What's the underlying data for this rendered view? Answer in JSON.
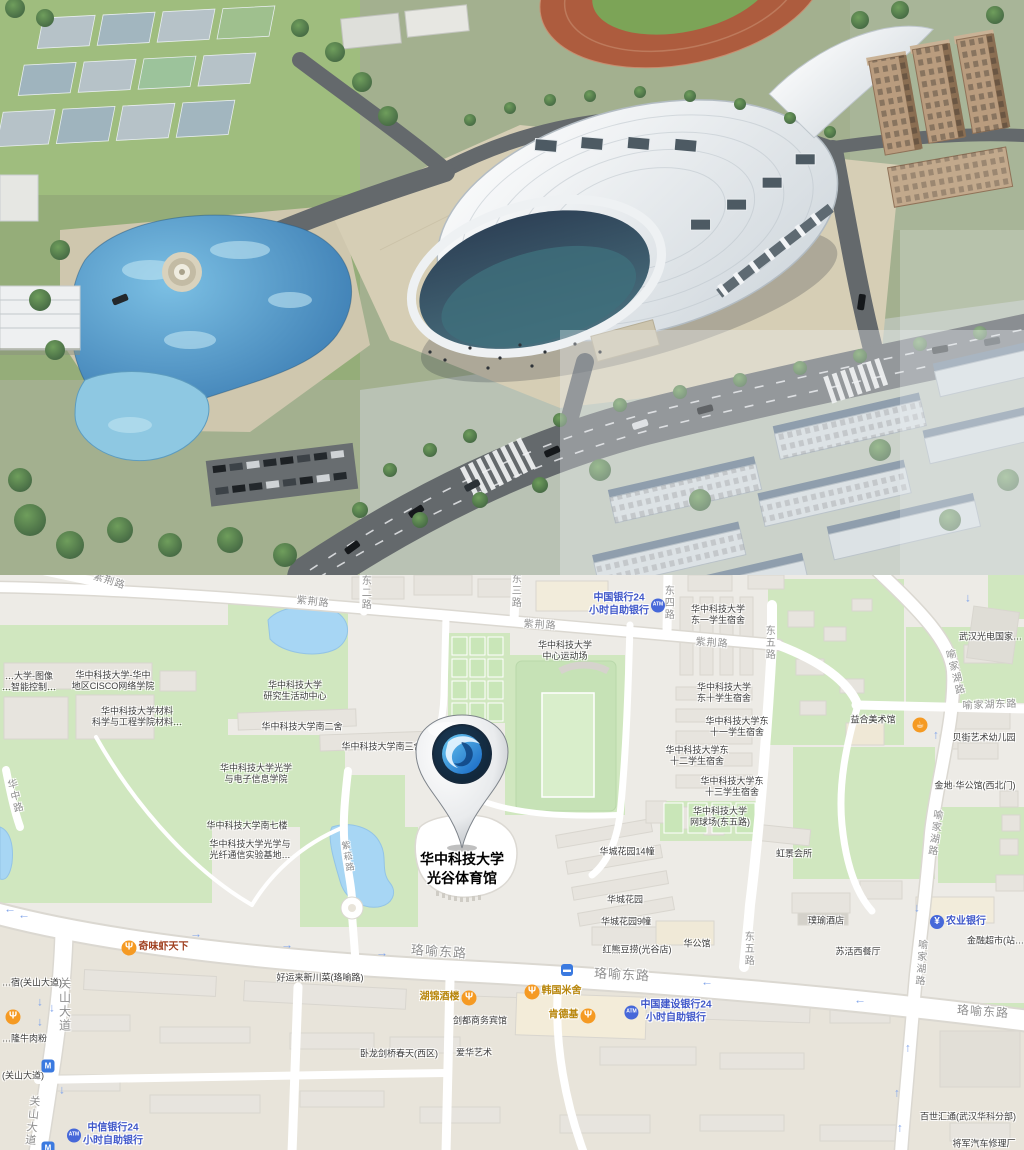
{
  "rendering": {
    "description": "Aerial architectural rendering of a large white oval-roofed gymnasium with glass facade, surrounded by a tan plaza, a blue landscaped swimming lagoon with circular fountain plaza, tennis courts and a running track to the north, perimeter roads with cars, zebra crossings, a parking lot, and rows of apartment buildings to the south-east"
  },
  "map": {
    "pin": {
      "label_line1": "华中科技大学",
      "label_line2": "光谷体育馆"
    },
    "colors": {
      "bank_blue": "#3f57c9",
      "food_gold": "#b8860b",
      "food_red": "#a04020",
      "poi_icon_orange": "#f59a23",
      "road_label_gray": "#8f8f8f",
      "poi_text": "#3c3c3c",
      "park_green": "#d0e7bf",
      "water_blue": "#a7d6f4",
      "map_bg": "#edebe6",
      "pin_logo_blue": "#2b7fd4"
    },
    "icons_legend": {
      "atm": "ATM",
      "yuan": "¥",
      "fork": "Ψ",
      "cup": "☕",
      "bus": "▬",
      "metro": "M"
    },
    "labels": [
      {
        "id": "zijing-1",
        "type": "road",
        "text": "紫荆路",
        "x": 109,
        "y": 7,
        "rot": 18
      },
      {
        "id": "zijing-2",
        "type": "road",
        "text": "紫荆路",
        "x": 313,
        "y": 28,
        "rot": 6
      },
      {
        "id": "zijing-3",
        "type": "road",
        "text": "紫荆路",
        "x": 540,
        "y": 51,
        "rot": 4
      },
      {
        "id": "zijing-4",
        "type": "road",
        "text": "紫荆路",
        "x": 712,
        "y": 69,
        "rot": 4
      },
      {
        "id": "dong2",
        "type": "road",
        "v": 1,
        "text": "东二路",
        "x": 364,
        "y": 18
      },
      {
        "id": "dong3",
        "type": "road",
        "v": 1,
        "text": "东三路",
        "x": 514,
        "y": 16
      },
      {
        "id": "dong4",
        "type": "road",
        "v": 1,
        "text": "东四路",
        "x": 667,
        "y": 28
      },
      {
        "id": "dong5-n",
        "type": "road",
        "v": 1,
        "text": "东五路",
        "x": 768,
        "y": 68
      },
      {
        "id": "dong5-s",
        "type": "road",
        "v": 1,
        "text": "东五路",
        "x": 747,
        "y": 374
      },
      {
        "id": "yujiahu-1",
        "type": "road",
        "v": 1,
        "text": "喻家湖路",
        "x": 953,
        "y": 98,
        "rot": -14
      },
      {
        "id": "yujiahu-2",
        "type": "road",
        "v": 1,
        "text": "喻家湖路",
        "x": 933,
        "y": 258,
        "rot": 8
      },
      {
        "id": "yujiahu-3",
        "type": "road",
        "v": 1,
        "text": "喻家湖路",
        "x": 919,
        "y": 388,
        "rot": 4
      },
      {
        "id": "yujiahu-dong",
        "type": "road",
        "text": "喻家湖东路",
        "x": 990,
        "y": 131,
        "rot": -2
      },
      {
        "id": "luoyu-1",
        "type": "road",
        "size": 13,
        "text": "珞喻东路",
        "x": 439,
        "y": 377,
        "rot": 4
      },
      {
        "id": "luoyu-2",
        "type": "road",
        "size": 13,
        "text": "珞喻东路",
        "x": 622,
        "y": 400,
        "rot": 3
      },
      {
        "id": "luoyu-3",
        "type": "road",
        "size": 12,
        "text": "珞喻东路",
        "x": 983,
        "y": 437,
        "rot": 4
      },
      {
        "id": "guanshan-1",
        "type": "road",
        "v": 1,
        "size": 12,
        "text": "关山大道",
        "x": 64,
        "y": 430
      },
      {
        "id": "guanshan-2",
        "type": "road",
        "v": 1,
        "size": 11,
        "text": "关山大道",
        "x": 31,
        "y": 546,
        "rot": 6
      },
      {
        "id": "huazhong",
        "type": "road",
        "v": 1,
        "size": 10,
        "text": "华中路",
        "x": 13,
        "y": 222,
        "rot": -14
      },
      {
        "id": "zisong",
        "type": "road",
        "v": 1,
        "size": 9,
        "text": "紫菘路",
        "x": 347,
        "y": 282,
        "rot": -10
      },
      {
        "id": "hust-dong1",
        "type": "poi",
        "text": "华中科技大学\n东一学生宿舍",
        "x": 718,
        "y": 40
      },
      {
        "id": "wuhan-optoel",
        "type": "poi",
        "text": "武汉光电国家…",
        "x": 1022,
        "y": 62,
        "align": "r"
      },
      {
        "id": "hust-field",
        "type": "poi",
        "text": "华中科技大学\n中心运动场",
        "x": 565,
        "y": 76
      },
      {
        "id": "boc",
        "type": "bank",
        "text": "中国银行24\n小时自助银行",
        "x": 627,
        "y": 30,
        "icon": "atm",
        "side": "right"
      },
      {
        "id": "hust-grad",
        "type": "poi",
        "text": "华中科技大学\n研究生活动中心",
        "x": 295,
        "y": 116
      },
      {
        "id": "hust-cisco",
        "type": "poi",
        "text": "华中科技大学-华中\n地区CISCO网络学院",
        "x": 113,
        "y": 106
      },
      {
        "id": "hust-image",
        "type": "poi",
        "text": "…大学-图像\n…智能控制…",
        "x": 2,
        "y": 107,
        "align": "l"
      },
      {
        "id": "hust-material",
        "type": "poi",
        "text": "华中科技大学材料\n科学与工程学院材料…",
        "x": 137,
        "y": 142
      },
      {
        "id": "hust-nan2",
        "type": "poi",
        "text": "华中科技大学南二舍",
        "x": 302,
        "y": 152
      },
      {
        "id": "hust-nan3",
        "type": "poi",
        "text": "华中科技大学南三舍",
        "x": 382,
        "y": 172
      },
      {
        "id": "hust-dong10",
        "type": "poi",
        "text": "华中科技大学\n东十学生宿舍",
        "x": 724,
        "y": 118
      },
      {
        "id": "yihe-gallery",
        "type": "poi",
        "text": "益合美术馆",
        "x": 873,
        "y": 145
      },
      {
        "id": "yihe-poi",
        "type": "store",
        "text": "",
        "x": 920,
        "y": 150,
        "icon": "cup"
      },
      {
        "id": "beijie-kg",
        "type": "poi",
        "text": "贝街艺术幼儿园",
        "x": 984,
        "y": 163
      },
      {
        "id": "hust-dong11",
        "type": "poi",
        "text": "华中科技大学东\n十一学生宿舍",
        "x": 737,
        "y": 152
      },
      {
        "id": "hust-dong12",
        "type": "poi",
        "text": "华中科技大学东\n十二学生宿舍",
        "x": 697,
        "y": 181
      },
      {
        "id": "hust-optics",
        "type": "poi",
        "text": "华中科技大学光学\n与电子信息学院",
        "x": 256,
        "y": 199
      },
      {
        "id": "jindi",
        "type": "poi",
        "text": "金地·华公馆(西北门)",
        "x": 975,
        "y": 211
      },
      {
        "id": "hust-dong13",
        "type": "poi",
        "text": "华中科技大学东\n十三学生宿舍",
        "x": 732,
        "y": 212
      },
      {
        "id": "hust-nan7",
        "type": "poi",
        "text": "华中科技大学南七楼",
        "x": 247,
        "y": 251
      },
      {
        "id": "hust-tennis",
        "type": "poi",
        "text": "华中科技大学\n网球场(东五路)",
        "x": 720,
        "y": 242
      },
      {
        "id": "hust-fiber",
        "type": "poi",
        "text": "华中科技大学光学与\n光纤通信实验基地…",
        "x": 250,
        "y": 275
      },
      {
        "id": "hongjing",
        "type": "poi",
        "text": "虹景会所",
        "x": 794,
        "y": 279
      },
      {
        "id": "huacheng14",
        "type": "poi",
        "text": "华城花园14幢",
        "x": 627,
        "y": 277
      },
      {
        "id": "huacheng",
        "type": "poi",
        "text": "华城花园",
        "x": 625,
        "y": 325
      },
      {
        "id": "huacheng9",
        "type": "poi",
        "text": "华城花园9幢",
        "x": 626,
        "y": 347
      },
      {
        "id": "puyu-hotel",
        "type": "poi",
        "text": "璞瑜酒店",
        "x": 826,
        "y": 346
      },
      {
        "id": "abc-bank",
        "type": "bank",
        "text": "农业银行",
        "x": 958,
        "y": 347,
        "icon": "yuan",
        "side": "left"
      },
      {
        "id": "suhuo",
        "type": "poi",
        "text": "苏活西餐厅",
        "x": 858,
        "y": 377
      },
      {
        "id": "finance-mart",
        "type": "poi",
        "text": "金融超市(站…",
        "x": 1024,
        "y": 366,
        "align": "r"
      },
      {
        "id": "hongxiong",
        "type": "poi",
        "text": "红熊豆捞(光谷店)",
        "x": 637,
        "y": 375
      },
      {
        "id": "huagongguan",
        "type": "poi",
        "text": "华公馆",
        "x": 697,
        "y": 369
      },
      {
        "id": "qiwei",
        "type": "food-red",
        "text": "奇味虾天下",
        "x": 155,
        "y": 373,
        "icon": "fork",
        "side": "left"
      },
      {
        "id": "bus-stop",
        "type": "store",
        "text": "",
        "x": 567,
        "y": 395,
        "icon": "bus"
      },
      {
        "id": "haoyunlai",
        "type": "poi",
        "text": "好运来新川菜(珞喻路)",
        "x": 320,
        "y": 403
      },
      {
        "id": "hujin",
        "type": "food",
        "text": "湖锦酒楼",
        "x": 448,
        "y": 423,
        "icon": "fork",
        "side": "right"
      },
      {
        "id": "hanguo",
        "type": "food",
        "text": "韩国米舍",
        "x": 553,
        "y": 417,
        "icon": "fork",
        "side": "left"
      },
      {
        "id": "jiandu",
        "type": "poi",
        "text": "剑都商务宾馆",
        "x": 480,
        "y": 446
      },
      {
        "id": "kfc",
        "type": "food",
        "text": "肯德基",
        "x": 572,
        "y": 441,
        "icon": "fork",
        "side": "right"
      },
      {
        "id": "ccb",
        "type": "bank",
        "text": "中国建设银行24\n小时自助银行",
        "x": 668,
        "y": 437,
        "icon": "atm",
        "side": "left"
      },
      {
        "id": "wolong",
        "type": "poi",
        "text": "卧龙剑桥春天(西区)",
        "x": 399,
        "y": 479
      },
      {
        "id": "aihua",
        "type": "poi",
        "text": "爱华艺术",
        "x": 474,
        "y": 478
      },
      {
        "id": "food-edge",
        "type": "store",
        "text": "",
        "x": 13,
        "y": 442,
        "icon": "fork"
      },
      {
        "id": "su-dorm",
        "type": "poi",
        "text": "…宿(关山大道)",
        "x": 2,
        "y": 408,
        "align": "l"
      },
      {
        "id": "niuroufen",
        "type": "poi",
        "text": "…隆牛肉粉",
        "x": 2,
        "y": 464,
        "align": "l"
      },
      {
        "id": "guanshan-p",
        "type": "poi",
        "text": "(关山大道)",
        "x": 2,
        "y": 501,
        "align": "l"
      },
      {
        "id": "metro-1",
        "type": "store",
        "text": "",
        "x": 48,
        "y": 491,
        "icon": "metro"
      },
      {
        "id": "citic",
        "type": "bank",
        "text": "中信银行24\n小时自助银行",
        "x": 105,
        "y": 560,
        "icon": "atm",
        "side": "left"
      },
      {
        "id": "metro-2",
        "type": "store",
        "text": "",
        "x": 48,
        "y": 573,
        "icon": "metro"
      },
      {
        "id": "baishi",
        "type": "poi",
        "text": "百世汇通(武汉华科分部)",
        "x": 968,
        "y": 542
      },
      {
        "id": "jiangjun",
        "type": "poi",
        "text": "将军汽车修理厂",
        "x": 984,
        "y": 569
      },
      {
        "id": "arr-1",
        "type": "arrow",
        "text": "↓",
        "x": 968,
        "y": 23
      },
      {
        "id": "arr-2",
        "type": "arrow",
        "text": "↑",
        "x": 936,
        "y": 160
      },
      {
        "id": "arr-3",
        "type": "arrow",
        "text": "↓",
        "x": 917,
        "y": 333
      },
      {
        "id": "arr-4",
        "type": "arrow",
        "text": "↑",
        "x": 908,
        "y": 473
      },
      {
        "id": "arr-5",
        "type": "arrow",
        "text": "↑",
        "x": 897,
        "y": 518
      },
      {
        "id": "arr-6",
        "type": "arrow",
        "text": "↑",
        "x": 900,
        "y": 553
      },
      {
        "id": "arr-7",
        "type": "arrow",
        "text": "→",
        "x": 196,
        "y": 359
      },
      {
        "id": "arr-8",
        "type": "arrow",
        "text": "→",
        "x": 287,
        "y": 370
      },
      {
        "id": "arr-9",
        "type": "arrow",
        "text": "→",
        "x": 382,
        "y": 378
      },
      {
        "id": "arr-10",
        "type": "arrow",
        "text": "←",
        "x": 707,
        "y": 407
      },
      {
        "id": "arr-11",
        "type": "arrow",
        "text": "←",
        "x": 860,
        "y": 425
      },
      {
        "id": "arr-12",
        "type": "arrow",
        "text": "←",
        "x": 10,
        "y": 334
      },
      {
        "id": "arr-13",
        "type": "arrow",
        "text": "←",
        "x": 24,
        "y": 340
      },
      {
        "id": "arr-14",
        "type": "arrow",
        "text": "↓",
        "x": 40,
        "y": 427
      },
      {
        "id": "arr-15",
        "type": "arrow",
        "text": "↓",
        "x": 52,
        "y": 433
      },
      {
        "id": "arr-16",
        "type": "arrow",
        "text": "↓",
        "x": 40,
        "y": 447
      },
      {
        "id": "arr-17",
        "type": "arrow",
        "text": "↓",
        "x": 62,
        "y": 515
      }
    ]
  }
}
